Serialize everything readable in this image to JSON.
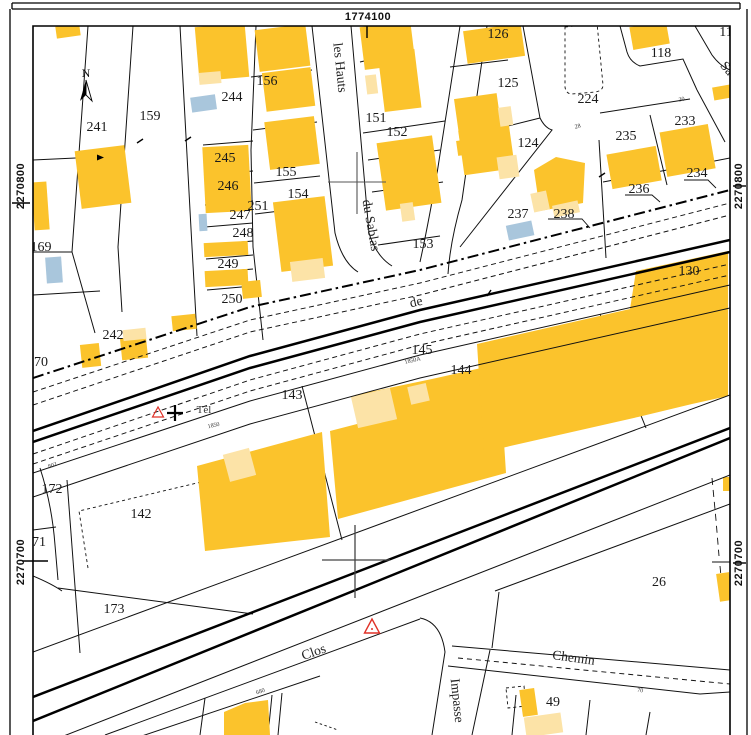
{
  "map": {
    "title": "cadastral-plan-view",
    "grid": {
      "x_label": "1774100",
      "y_top_left": "2270800",
      "y_top_right": "2270800",
      "y_bottom_left": "2270700",
      "y_bottom_right": "2270700"
    },
    "north_label": "N",
    "colors": {
      "building_hard": "#FBC32C",
      "building_light": "#FCE3A7",
      "building_annex_blue": "#A9C6DC",
      "line": "#111111",
      "geodetic_red": "#E03127",
      "paper": "#FFFFFF"
    },
    "parcels": [
      {
        "n": "241",
        "x": 97,
        "y": 131
      },
      {
        "n": "159",
        "x": 150,
        "y": 120
      },
      {
        "n": "169",
        "x": 41,
        "y": 251
      },
      {
        "n": "156",
        "x": 267,
        "y": 85
      },
      {
        "n": "244",
        "x": 232,
        "y": 101
      },
      {
        "n": "245",
        "x": 225,
        "y": 162
      },
      {
        "n": "246",
        "x": 228,
        "y": 190
      },
      {
        "n": "247",
        "x": 240,
        "y": 219
      },
      {
        "n": "248",
        "x": 243,
        "y": 237
      },
      {
        "n": "249",
        "x": 228,
        "y": 268
      },
      {
        "n": "251",
        "x": 258,
        "y": 210
      },
      {
        "n": "250",
        "x": 232,
        "y": 303
      },
      {
        "n": "242",
        "x": 113,
        "y": 339
      },
      {
        "n": "70",
        "x": 41,
        "y": 366
      },
      {
        "n": "155",
        "x": 286,
        "y": 176
      },
      {
        "n": "154",
        "x": 298,
        "y": 198
      },
      {
        "n": "151",
        "x": 376,
        "y": 122
      },
      {
        "n": "152",
        "x": 397,
        "y": 136
      },
      {
        "n": "153",
        "x": 423,
        "y": 248
      },
      {
        "n": "126",
        "x": 498,
        "y": 38
      },
      {
        "n": "125",
        "x": 508,
        "y": 87
      },
      {
        "n": "224",
        "x": 588,
        "y": 103
      },
      {
        "n": "118",
        "x": 661,
        "y": 57
      },
      {
        "n": "124",
        "x": 528,
        "y": 147
      },
      {
        "n": "233",
        "x": 685,
        "y": 125
      },
      {
        "n": "235",
        "x": 626,
        "y": 140
      },
      {
        "n": "234",
        "x": 697,
        "y": 177
      },
      {
        "n": "236",
        "x": 639,
        "y": 193
      },
      {
        "n": "237",
        "x": 518,
        "y": 218
      },
      {
        "n": "238",
        "x": 564,
        "y": 218
      },
      {
        "n": "130",
        "x": 689,
        "y": 275
      },
      {
        "n": "145",
        "x": 422,
        "y": 354
      },
      {
        "n": "144",
        "x": 461,
        "y": 374
      },
      {
        "n": "143",
        "x": 292,
        "y": 399
      },
      {
        "n": "142",
        "x": 141,
        "y": 518
      },
      {
        "n": "172",
        "x": 52,
        "y": 493
      },
      {
        "n": "71",
        "x": 39,
        "y": 546
      },
      {
        "n": "173",
        "x": 114,
        "y": 613
      },
      {
        "n": "26",
        "x": 659,
        "y": 586
      },
      {
        "n": "49",
        "x": 553,
        "y": 706
      },
      {
        "n": "11",
        "x": 726,
        "y": 36
      }
    ],
    "streets": [
      {
        "name": "les Hauts",
        "x": 336,
        "y": 68,
        "rot": 84
      },
      {
        "name": "du Sablas",
        "x": 367,
        "y": 226,
        "rot": 80
      },
      {
        "name": "de",
        "x": 417,
        "y": 306,
        "rot": -13
      },
      {
        "name": "Clos",
        "x": 315,
        "y": 656,
        "rot": -19
      },
      {
        "name": "Chemin",
        "x": 573,
        "y": 662,
        "rot": 8
      },
      {
        "name": "Impasse",
        "x": 453,
        "y": 701,
        "rot": 84
      },
      {
        "name": "Sa",
        "x": 724,
        "y": 71,
        "rot": 50
      }
    ],
    "annotations": [
      {
        "text": "Tél",
        "x": 204,
        "y": 413,
        "rot": 0,
        "size": 11
      },
      {
        "text": "1850",
        "x": 214,
        "y": 427,
        "rot": -13,
        "size": 6
      },
      {
        "text": "1850A",
        "x": 413,
        "y": 362,
        "rot": -13,
        "size": 6
      },
      {
        "text": "802",
        "x": 53,
        "y": 467,
        "rot": -18,
        "size": 6
      },
      {
        "text": "680",
        "x": 261,
        "y": 693,
        "rot": -19,
        "size": 6
      },
      {
        "text": "70",
        "x": 640,
        "y": 692,
        "rot": 8,
        "size": 6
      },
      {
        "text": "30",
        "x": 682,
        "y": 101,
        "rot": -12,
        "size": 6
      },
      {
        "text": "28",
        "x": 578,
        "y": 128,
        "rot": -12,
        "size": 6
      }
    ]
  }
}
